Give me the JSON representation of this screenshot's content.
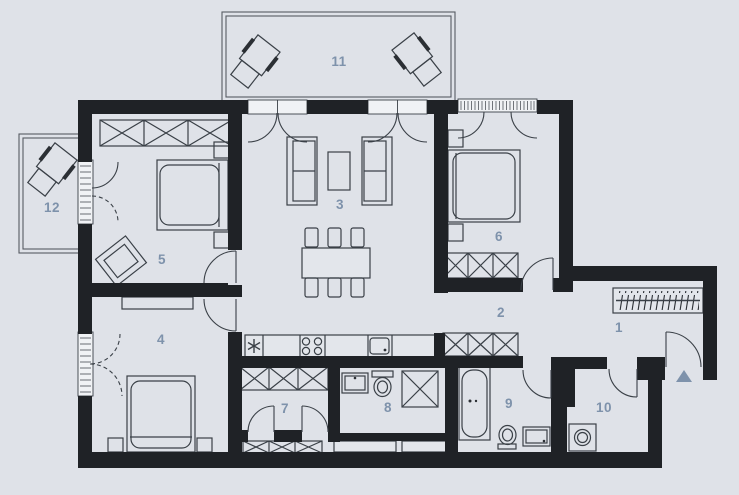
{
  "plan": {
    "kind": "apartment-floor-plan",
    "entry_marker": "triangle-up"
  },
  "colors": {
    "background": "#dfe2e8",
    "wall": "#1f2226",
    "furniture_line": "#3a4047",
    "opening_fill": "#f0f2f5",
    "label": "#7e92ab",
    "balcony_line": "#565b63",
    "accent": "#7e92ab"
  },
  "rooms": [
    {
      "number": "1"
    },
    {
      "number": "2"
    },
    {
      "number": "3"
    },
    {
      "number": "4"
    },
    {
      "number": "5"
    },
    {
      "number": "6"
    },
    {
      "number": "7"
    },
    {
      "number": "8"
    },
    {
      "number": "9"
    },
    {
      "number": "10"
    },
    {
      "number": "11"
    },
    {
      "number": "12"
    }
  ]
}
